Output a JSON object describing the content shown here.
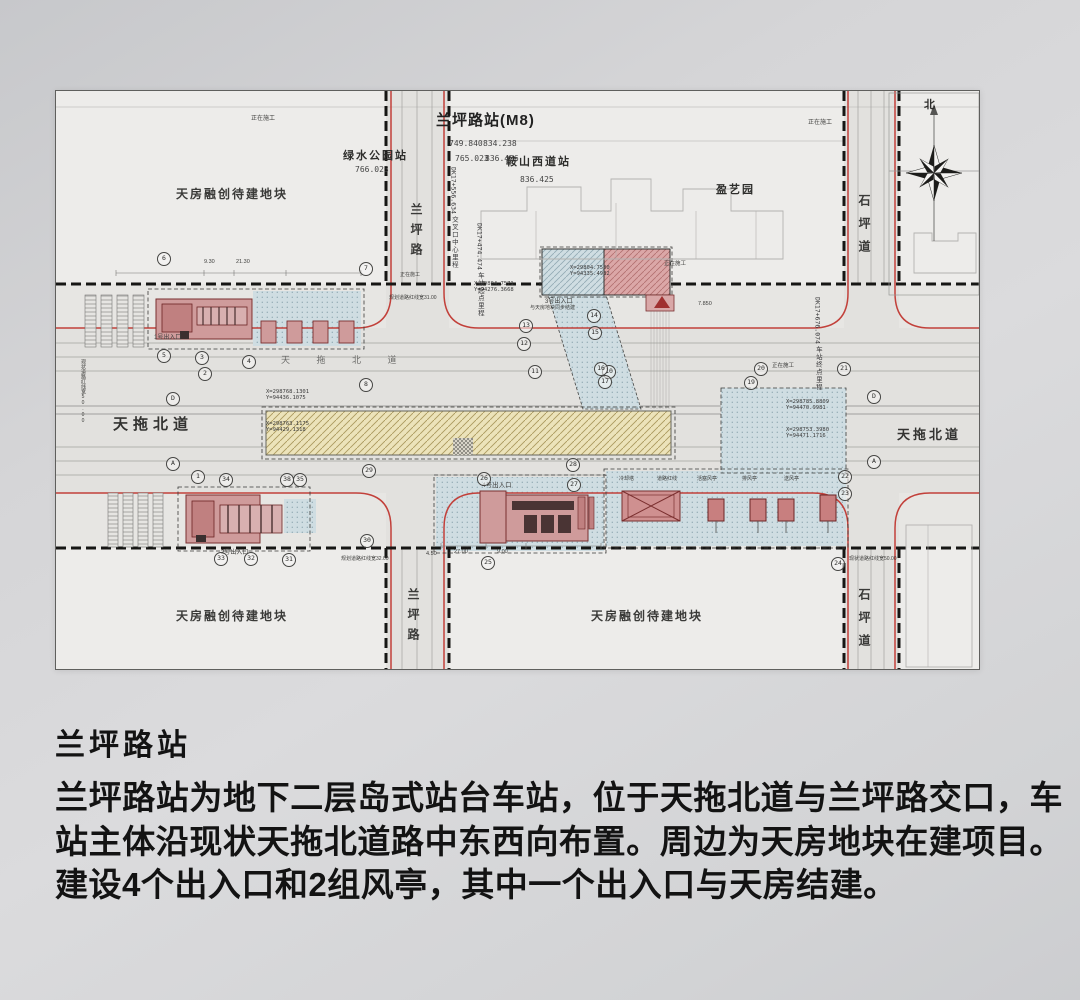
{
  "colors": {
    "accent_red": "#c0392b",
    "station_fill": "#ece3ba",
    "entrance_fill": "#cf9b9b",
    "blue_zone": "#cfdde2"
  },
  "drawing": {
    "title": "兰坪路站(M8)",
    "north": "北",
    "neighbor_stations": {
      "green_park": {
        "name": "绿水公园站",
        "value": "766.023"
      },
      "anshan_west": {
        "name": "鞍山西道站",
        "value": "836.425"
      }
    },
    "corner_values": [
      "749.840",
      "765.023",
      "834.238",
      "836.426"
    ],
    "roads": {
      "lanping": "兰坪路",
      "shiping": "石坪道",
      "tiantuo": "天拖北道"
    },
    "parcels": {
      "tianfang": "天房融创待建地块",
      "yingyiyuan": "盈艺园"
    },
    "mileage": {
      "start_label": "车站起点里程",
      "start_value": "DK17+474.474",
      "center_label": "交叉口中心里程",
      "center_value": "DK17+556.634",
      "end_label": "车站终点里程",
      "end_value": "DK17+676.074"
    },
    "notes": [
      {
        "x": 195,
        "y": 22,
        "t": "正在施工",
        "fs": 6
      },
      {
        "x": 752,
        "y": 26,
        "t": "正在施工",
        "fs": 6
      },
      {
        "x": 608,
        "y": 168,
        "t": "正在施工",
        "fs": 5.5
      },
      {
        "x": 716,
        "y": 270,
        "t": "正在施工",
        "fs": 5.5
      },
      {
        "x": 344,
        "y": 180,
        "t": "正在施工",
        "fs": 5
      },
      {
        "x": 333,
        "y": 203,
        "t": "规划道路红线宽31.00",
        "fs": 5
      },
      {
        "x": 285,
        "y": 464,
        "t": "规划道路红线宽32.00",
        "fs": 5
      },
      {
        "x": 793,
        "y": 464,
        "t": "现状道路红线宽50.00",
        "fs": 5
      },
      {
        "x": 24,
        "y": 268,
        "t": "现状道路红线宽50.00",
        "fs": 5,
        "v": true
      },
      {
        "x": 98,
        "y": 241,
        "t": "1号出入口",
        "fs": 6
      },
      {
        "x": 165,
        "y": 456,
        "t": "2号出入口",
        "fs": 6
      },
      {
        "x": 426,
        "y": 388,
        "t": "4号出入口",
        "fs": 6.5
      },
      {
        "x": 489,
        "y": 205,
        "t": "3号出入口",
        "fs": 6
      },
      {
        "x": 474,
        "y": 213,
        "t": "与天房地块同步结建",
        "fs": 5
      },
      {
        "x": 563,
        "y": 384,
        "t": "冷却塔",
        "fs": 5
      },
      {
        "x": 601,
        "y": 384,
        "t": "道路红线",
        "fs": 5
      },
      {
        "x": 641,
        "y": 384,
        "t": "活塞风亭",
        "fs": 5
      },
      {
        "x": 686,
        "y": 384,
        "t": "排风亭",
        "fs": 5
      },
      {
        "x": 728,
        "y": 384,
        "t": "送风亭",
        "fs": 5
      },
      {
        "x": 148,
        "y": 168,
        "t": "9.30",
        "fs": 5.5
      },
      {
        "x": 180,
        "y": 168,
        "t": "21.30",
        "fs": 5.5
      },
      {
        "x": 398,
        "y": 458,
        "t": "27.00",
        "fs": 5.5
      },
      {
        "x": 441,
        "y": 458,
        "t": "9.00",
        "fs": 5.5
      },
      {
        "x": 370,
        "y": 460,
        "t": "4.50",
        "fs": 5.5
      },
      {
        "x": 642,
        "y": 210,
        "t": "7.850",
        "fs": 5.5
      },
      {
        "x": 225,
        "y": 262,
        "t": "天 拖 北 道",
        "fs": 9,
        "ls": 12,
        "c": "#6a6a68"
      }
    ],
    "coords": [
      {
        "x": 418,
        "y": 190,
        "l1": "X=29804.7571",
        "l2": "Y=94276.3668"
      },
      {
        "x": 514,
        "y": 174,
        "l1": "X=29804.7500",
        "l2": "Y=94335.4932"
      },
      {
        "x": 210,
        "y": 298,
        "l1": "X=298768.1301",
        "l2": "Y=94436.1075"
      },
      {
        "x": 210,
        "y": 330,
        "l1": "X=298763.1175",
        "l2": "Y=94429.1318"
      },
      {
        "x": 730,
        "y": 308,
        "l1": "X=298785.8809",
        "l2": "Y=94470.9981"
      },
      {
        "x": 730,
        "y": 336,
        "l1": "X=298753.3980",
        "l2": "Y=94471.1716"
      }
    ],
    "callouts": [
      {
        "x": 108,
        "y": 168,
        "t": "6"
      },
      {
        "x": 310,
        "y": 178,
        "t": "7"
      },
      {
        "x": 310,
        "y": 294,
        "t": "8"
      },
      {
        "x": 108,
        "y": 265,
        "t": "5"
      },
      {
        "x": 146,
        "y": 267,
        "t": "3"
      },
      {
        "x": 149,
        "y": 283,
        "t": "2"
      },
      {
        "x": 117,
        "y": 308,
        "t": "D"
      },
      {
        "x": 117,
        "y": 373,
        "t": "A"
      },
      {
        "x": 142,
        "y": 386,
        "t": "1"
      },
      {
        "x": 170,
        "y": 389,
        "t": "34"
      },
      {
        "x": 231,
        "y": 389,
        "t": "38"
      },
      {
        "x": 244,
        "y": 389,
        "t": "35"
      },
      {
        "x": 313,
        "y": 380,
        "t": "29"
      },
      {
        "x": 165,
        "y": 468,
        "t": "33"
      },
      {
        "x": 195,
        "y": 468,
        "t": "32"
      },
      {
        "x": 233,
        "y": 469,
        "t": "31"
      },
      {
        "x": 311,
        "y": 450,
        "t": "30"
      },
      {
        "x": 428,
        "y": 388,
        "t": "26"
      },
      {
        "x": 517,
        "y": 374,
        "t": "28"
      },
      {
        "x": 518,
        "y": 394,
        "t": "27"
      },
      {
        "x": 432,
        "y": 472,
        "t": "25"
      },
      {
        "x": 789,
        "y": 386,
        "t": "22"
      },
      {
        "x": 789,
        "y": 403,
        "t": "23"
      },
      {
        "x": 782,
        "y": 473,
        "t": "24"
      },
      {
        "x": 818,
        "y": 306,
        "t": "D"
      },
      {
        "x": 818,
        "y": 371,
        "t": "A"
      },
      {
        "x": 470,
        "y": 235,
        "t": "13"
      },
      {
        "x": 468,
        "y": 253,
        "t": "12"
      },
      {
        "x": 538,
        "y": 225,
        "t": "14"
      },
      {
        "x": 539,
        "y": 242,
        "t": "15"
      },
      {
        "x": 479,
        "y": 281,
        "t": "11"
      },
      {
        "x": 553,
        "y": 281,
        "t": "10"
      },
      {
        "x": 695,
        "y": 292,
        "t": "19"
      },
      {
        "x": 705,
        "y": 278,
        "t": "20"
      },
      {
        "x": 788,
        "y": 278,
        "t": "21"
      },
      {
        "x": 193,
        "y": 271,
        "t": "4"
      },
      {
        "x": 545,
        "y": 278,
        "t": "16"
      },
      {
        "x": 549,
        "y": 291,
        "t": "17"
      }
    ]
  },
  "caption": {
    "heading": "兰坪路站",
    "body": "兰坪路站为地下二层岛式站台车站，位于天拖北道与兰坪路交口，车站主体沿现状天拖北道路中东西向布置。周边为天房地块在建项目。建设4个出入口和2组风亭，其中一个出入口与天房结建。"
  }
}
